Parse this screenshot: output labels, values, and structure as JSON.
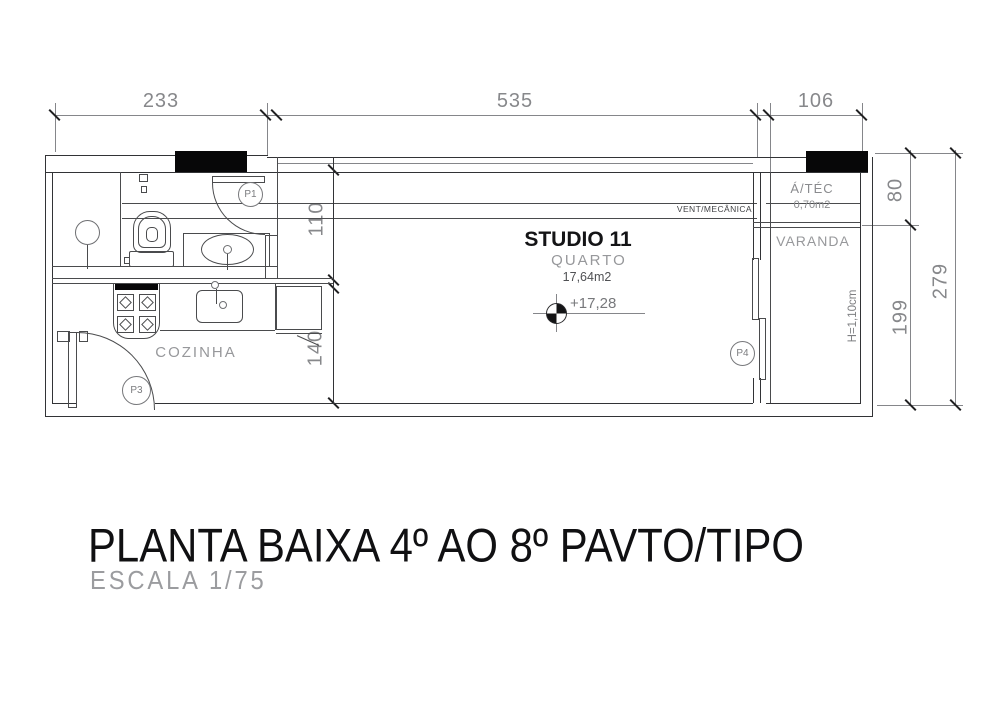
{
  "title": {
    "main": "PLANTA BAIXA 4º AO 8º  PAVTO/TIPO",
    "scale": "ESCALA  1/75"
  },
  "rooms": {
    "studio_name": "STUDIO 11",
    "studio_sub": "QUARTO",
    "studio_area": "17,64m2",
    "studio_level": "+17,28",
    "cozinha": "COZINHA",
    "varanda": "VARANDA",
    "atec_name": "Á/TÉC",
    "atec_area": "0,70m2",
    "atec_height_note": "H=1,10cm",
    "vent_band": "VENT/MECÂNICA"
  },
  "doors": {
    "p1": "P1",
    "p3": "P3",
    "p4": "P4"
  },
  "dims": {
    "t233": "233",
    "t535": "535",
    "t106": "106",
    "r80": "80",
    "r199": "199",
    "r279": "279",
    "i110": "110",
    "i140": "140"
  },
  "colors": {
    "line": "#4a4b4d",
    "dim_text": "#87888b",
    "dark_text": "#141416",
    "column_fill": "#070708"
  }
}
